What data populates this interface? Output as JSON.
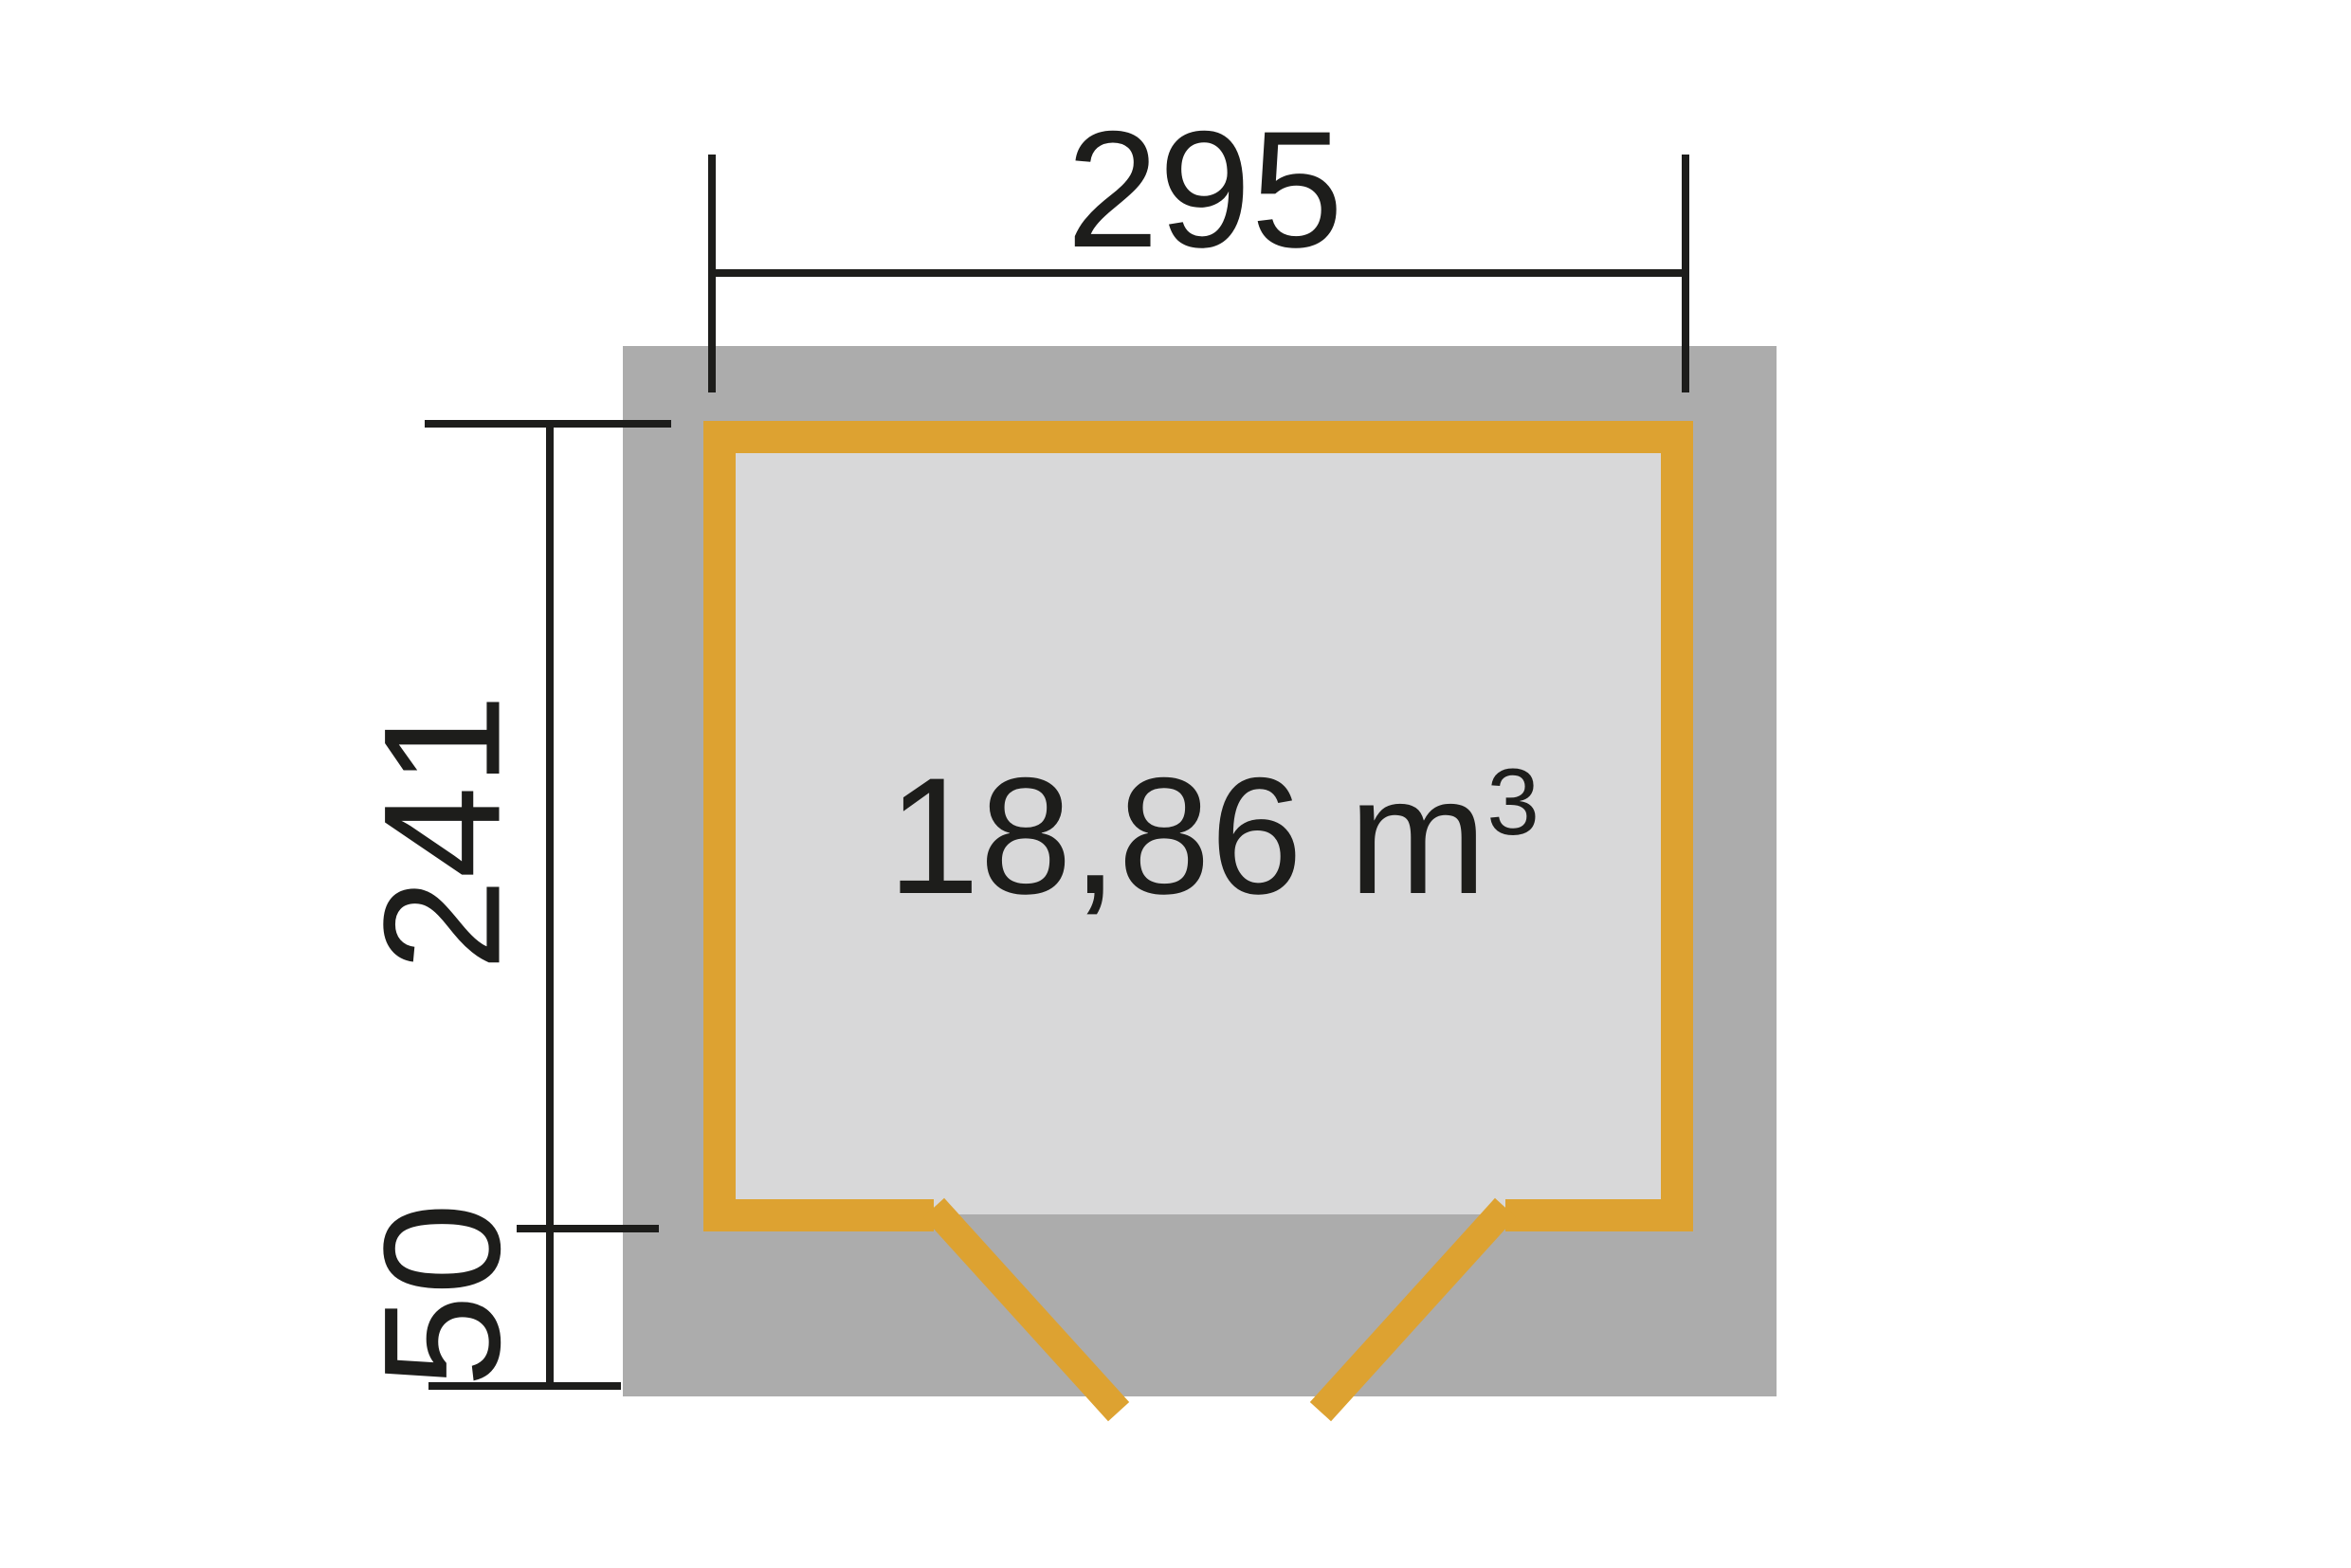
{
  "page": {
    "background": "#ffffff"
  },
  "floor_plan": {
    "width_label": "295",
    "depth_label": "241",
    "overhang_label": "50",
    "volume_base": "18,86 m",
    "volume_exponent": "3",
    "colors": {
      "base_gray": "#acacac",
      "floor_gray": "#d8d8d9",
      "wall_orange": "#dda231",
      "dimension_black": "#1d1d1b"
    }
  }
}
